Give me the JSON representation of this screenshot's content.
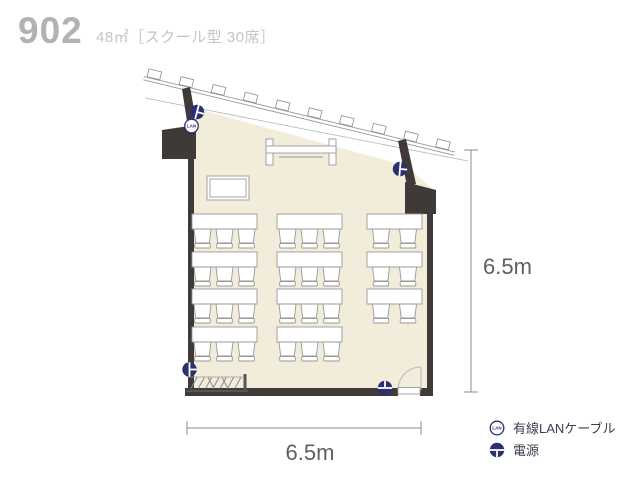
{
  "header": {
    "room_number": "902",
    "room_spec": "48㎡［スクール型 30席］"
  },
  "dimensions": {
    "width_label": "6.5m",
    "height_label": "6.5m"
  },
  "legend": {
    "lan": {
      "icon_text": "LAN",
      "label": "有線LANケーブル"
    },
    "power": {
      "label": "電源"
    }
  },
  "floorplan": {
    "room_type": "スクール型",
    "seat_count": 30,
    "area_sqm": 48,
    "columns": [
      {
        "name": "left",
        "desks": 4,
        "chairs_per_desk": 3
      },
      {
        "name": "middle",
        "desks": 4,
        "chairs_per_desk": 3
      },
      {
        "name": "right",
        "desks": 3,
        "chairs_per_desk": 2
      }
    ],
    "features": [
      "slanted-window-wall-top",
      "door-bottom-right",
      "coat-rack-bottom-left",
      "whiteboard-top-center",
      "lectern-top-left",
      "power-outlet-top-left",
      "power-outlet-right",
      "power-outlet-bottom-left",
      "power-outlet-bottom-right",
      "lan-port-top-left"
    ]
  },
  "colors": {
    "floor": "#f2ecda",
    "wall": "#3f3a38",
    "accent_navy": "#2b3170",
    "furniture_outline": "#999999",
    "dimension_text": "#5f5f5f",
    "title": "#b2b2b2",
    "subtitle": "#c5c5c5",
    "legend_text": "#3c3c4e"
  }
}
